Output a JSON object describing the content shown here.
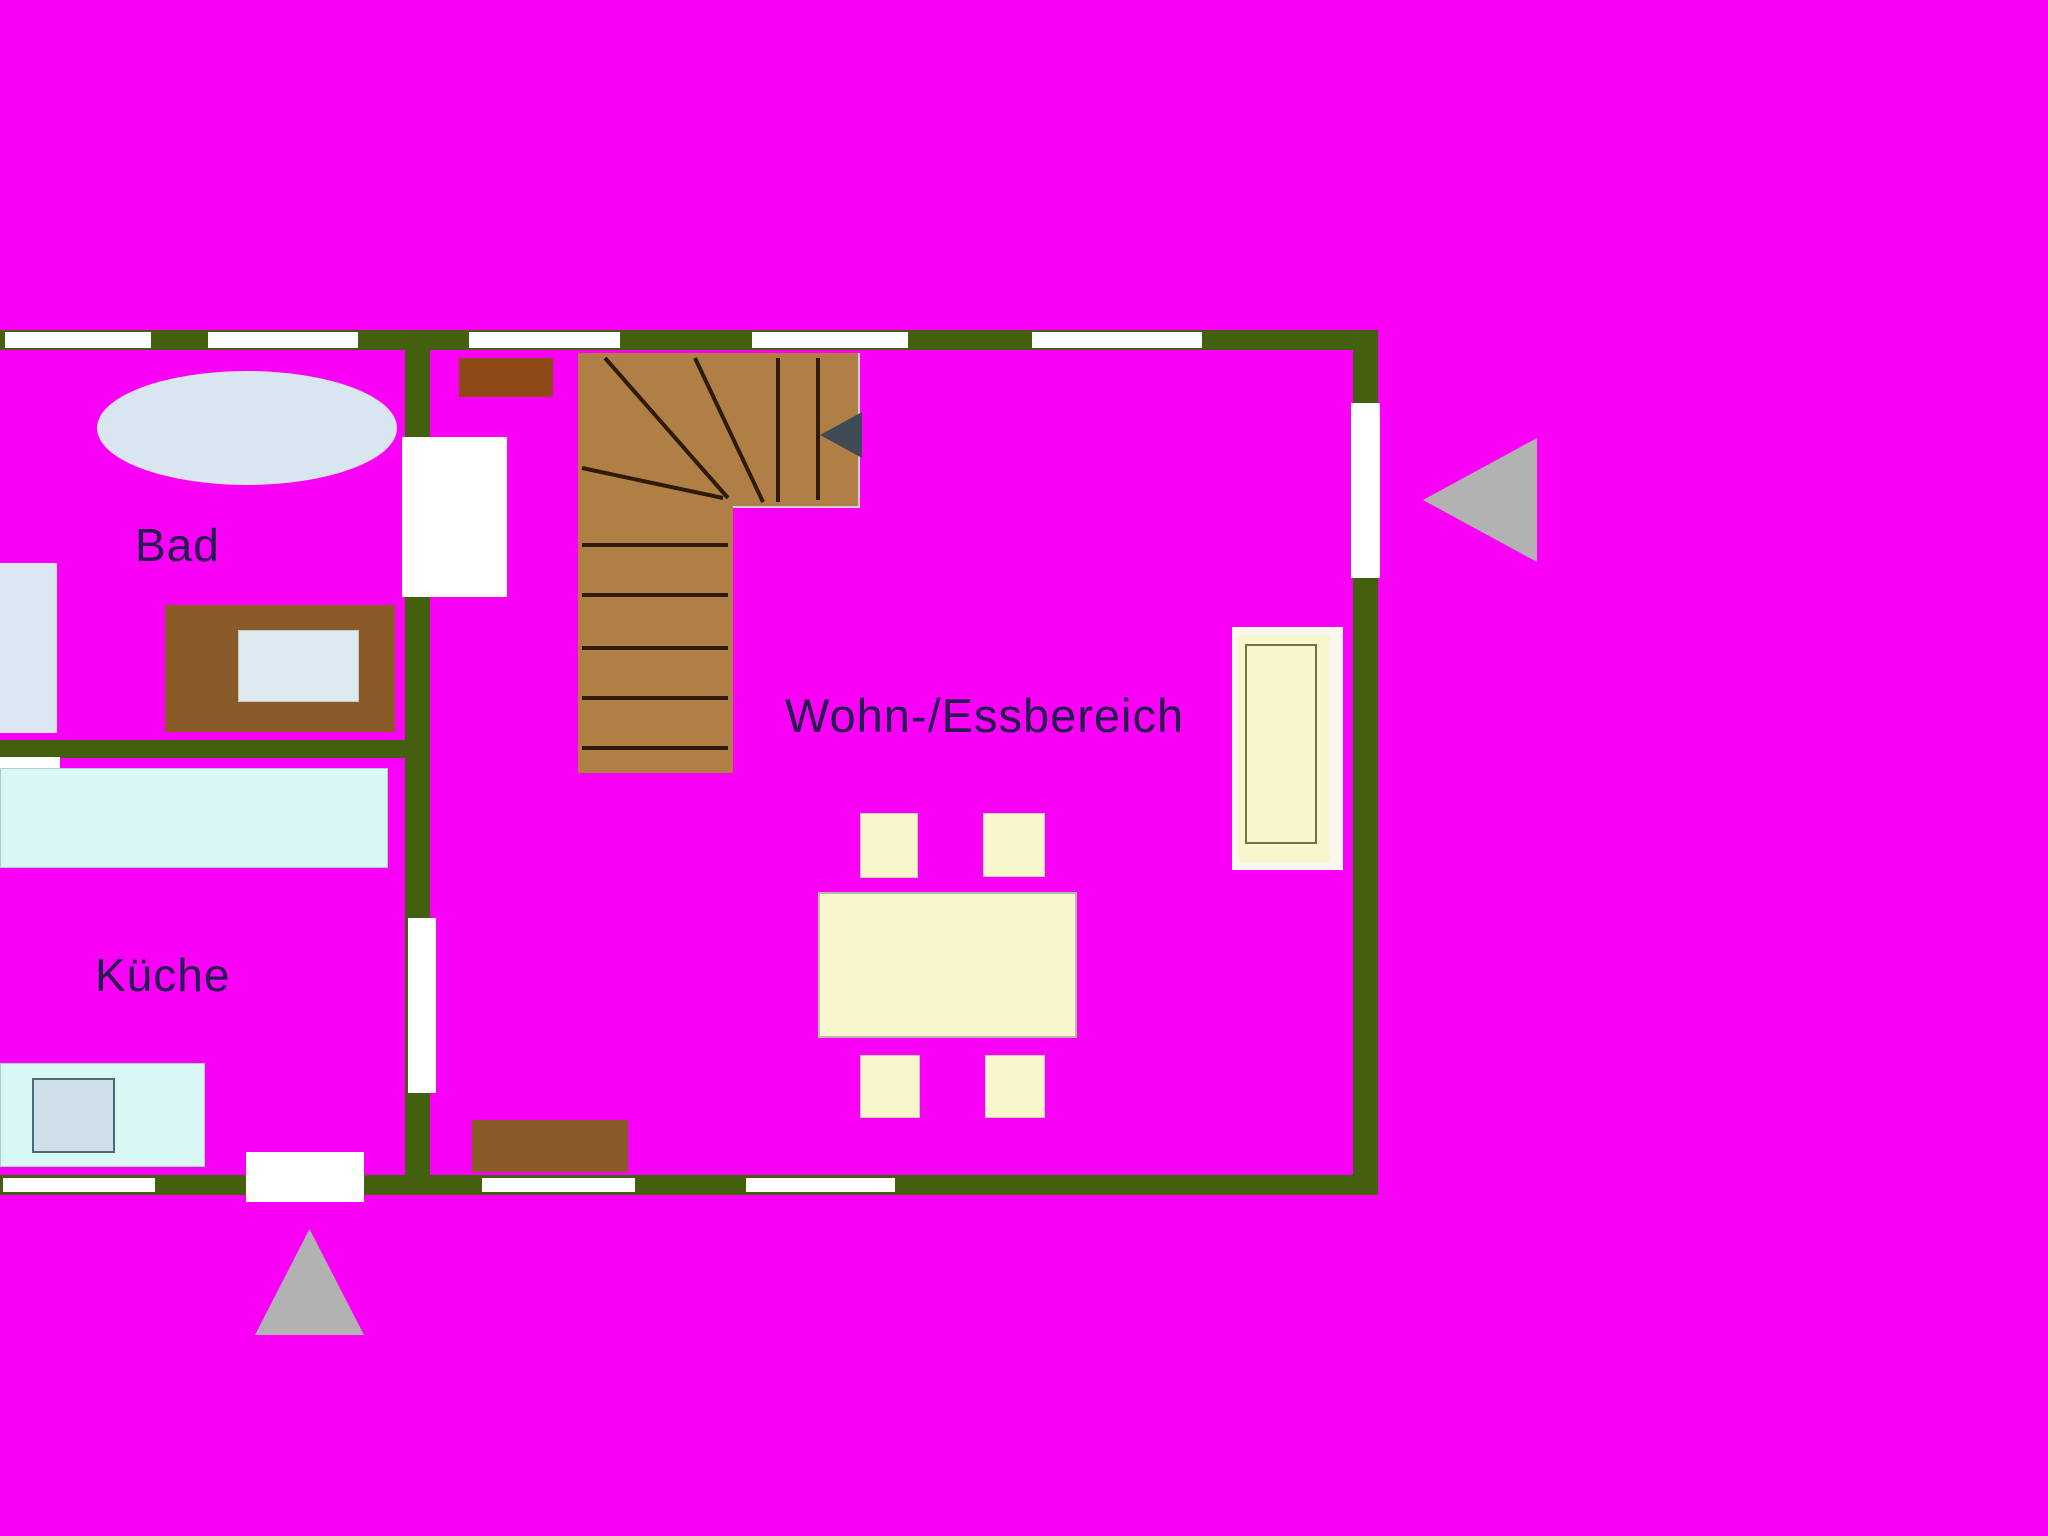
{
  "floor_plan": {
    "rooms": [
      {
        "name": "bad",
        "label": "Bad"
      },
      {
        "name": "kueche",
        "label": "Küche"
      },
      {
        "name": "wohn-essbereich",
        "label": "Wohn-/Essbereich"
      }
    ],
    "icons": [
      {
        "name": "entrance-arrow-right",
        "meaning": "gray arrow pointing left toward window in right wall"
      },
      {
        "name": "entrance-arrow-bottom",
        "meaning": "gray arrow pointing up toward door in bottom wall"
      },
      {
        "name": "stair-direction-arrow",
        "meaning": "dark arrow on staircase pointing left"
      }
    ],
    "colors": {
      "background": "#fa00f6",
      "wall": "#42600e",
      "opening": "#ffffff",
      "stairs": "#b07f45",
      "stair_line": "#2f1a05",
      "wood_furniture": "#8a5a28",
      "wood_furniture_dark": "#8d4a16",
      "bath_fixture": "#d9e5ef",
      "kitchen_counter": "#d9f7f5",
      "sink": "#cfdfe8",
      "cream_furniture": "#f7f6cd",
      "arrow_gray": "#b2b2b2",
      "stair_arrow": "#3f4a55",
      "label_text": "#241b50"
    }
  }
}
